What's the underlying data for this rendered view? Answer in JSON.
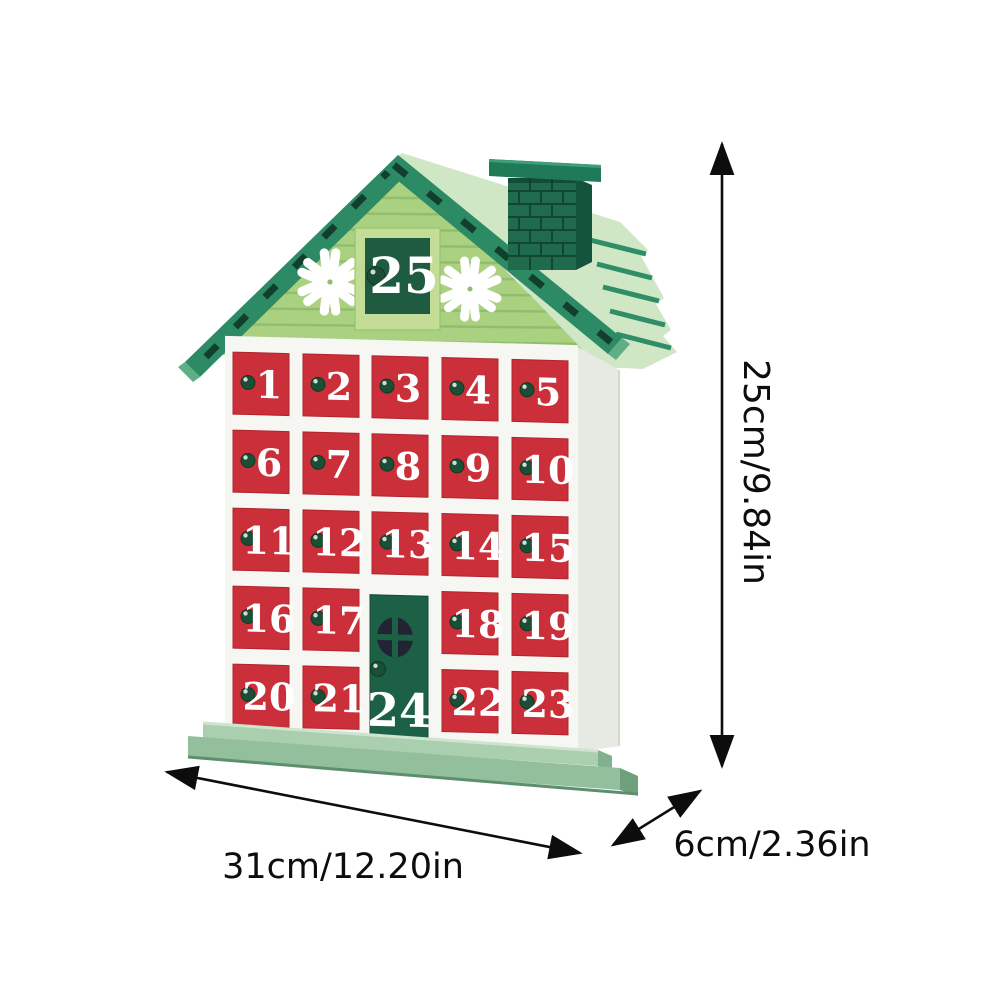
{
  "product": {
    "type": "wooden-advent-calendar-house",
    "roof_window_number": "25",
    "door_number": "24",
    "drawer_numbers": [
      "1",
      "2",
      "3",
      "4",
      "5",
      "6",
      "7",
      "8",
      "9",
      "10",
      "11",
      "12",
      "13",
      "14",
      "15",
      "16",
      "17",
      "18",
      "19",
      "20",
      "21",
      "22",
      "23"
    ]
  },
  "dimensions": {
    "height_label": "25cm/9.84in",
    "width_label": "31cm/12.20in",
    "depth_label": "6cm/2.36in"
  },
  "colors": {
    "background": "#ffffff",
    "roof_green": "#2c8a65",
    "roof_slot_dark": "#123f2d",
    "roof_plane_mint": "#cfe7c4",
    "roof_tip_cut": "#5fae85",
    "gable_green": "#a9d180",
    "gable_slat": "#93bd6e",
    "chimney_green": "#206a4e",
    "chimney_side": "#14543c",
    "chimney_cap": "#1f7b57",
    "window_frame": "#c3dd97",
    "window_inner": "#1e5b40",
    "drawer_red": "#cb2f3a",
    "door_green": "#1c6145",
    "door_window": "#232433",
    "knob_green": "#1a4f36",
    "knob_red": "#c6333b",
    "body_white": "#f6f7f3",
    "side_wall": "#e7eae3",
    "base_green_light": "#a9cfae",
    "base_green": "#93bf9d",
    "number_white": "#ffffff",
    "annotation_black": "#0d0d0d"
  }
}
